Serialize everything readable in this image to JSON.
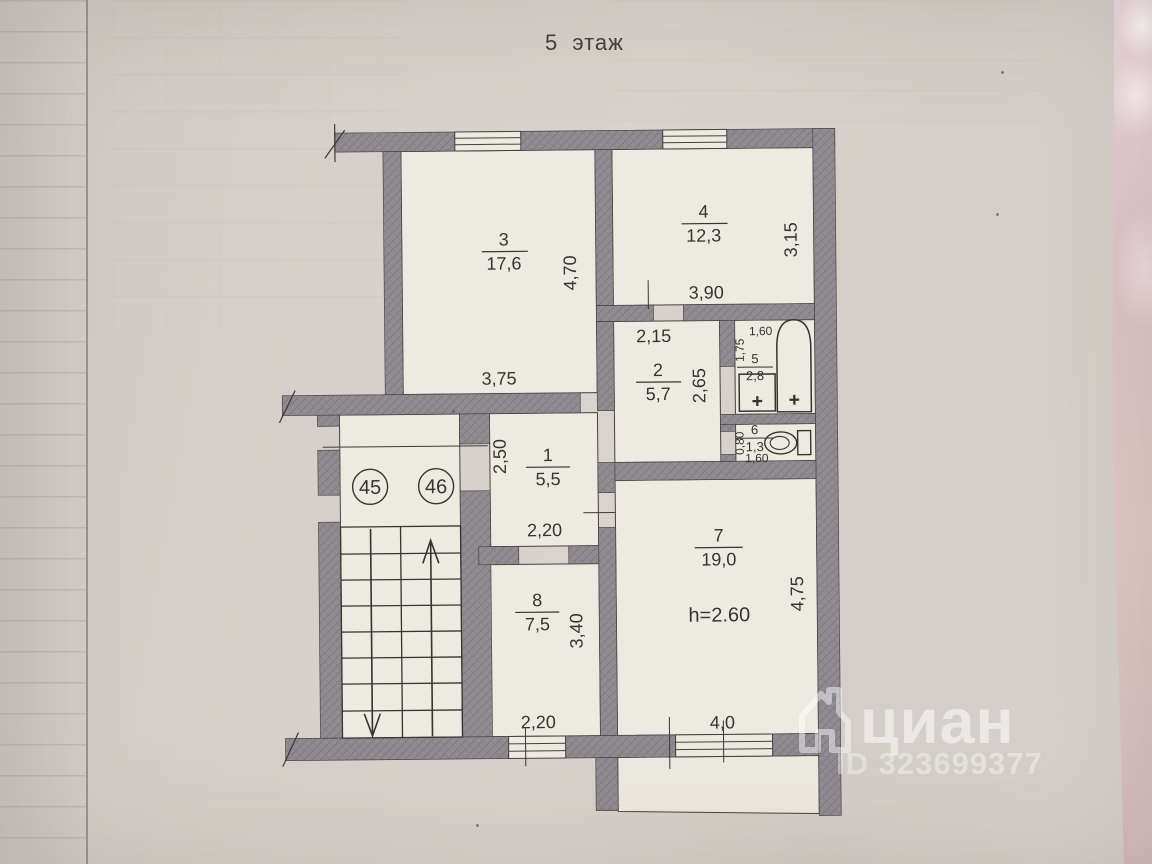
{
  "title": "5 этаж",
  "plan": {
    "ceiling_height": "h=2.60",
    "stairwell": {
      "apartment_circles": [
        "45",
        "46"
      ]
    },
    "rooms": [
      {
        "number": "1",
        "area": "5,5",
        "width": "2,20",
        "depth": "2,50"
      },
      {
        "number": "2",
        "area": "5,7",
        "width": "2,15",
        "depth": "2,65"
      },
      {
        "number": "3",
        "area": "17,6",
        "width": "3,75",
        "depth": "4,70"
      },
      {
        "number": "4",
        "area": "12,3",
        "width": "3,90",
        "depth": "3,15"
      },
      {
        "number": "5",
        "area": "2,8",
        "width": "1,60",
        "depth": "1,75"
      },
      {
        "number": "6",
        "area": "1,3",
        "width": "1,60",
        "depth": "0,80"
      },
      {
        "number": "7",
        "area": "19,0",
        "width": "4,0",
        "depth": "4,75"
      },
      {
        "number": "8",
        "area": "7,5",
        "width": "2,20",
        "depth": "3,40"
      }
    ]
  },
  "watermark": {
    "brand": "циан",
    "listing_id": "ID 323699377"
  },
  "colors": {
    "wall_fill": "#8f8c91",
    "room_fill": "#edeae2",
    "ink": "#3c3835",
    "paper": "#d5d0c9",
    "fabric_pink": "#e3c9cb"
  }
}
